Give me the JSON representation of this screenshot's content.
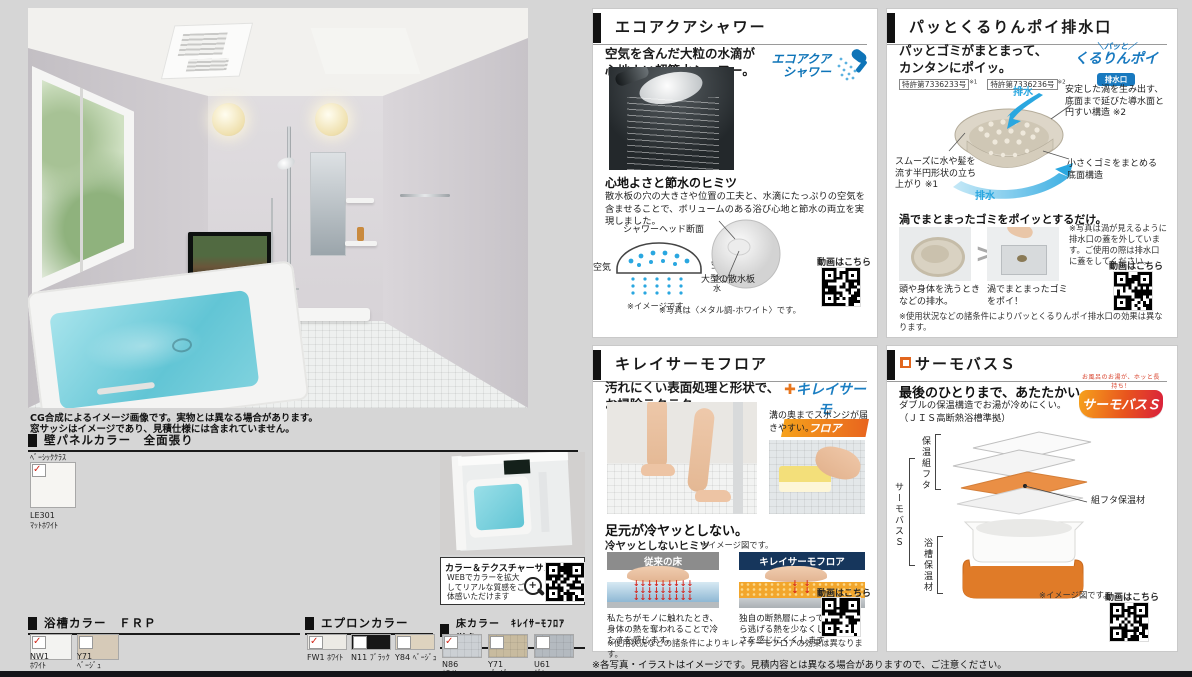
{
  "page": {
    "photo_notes": [
      "CG合成によるイメージ画像です。実物とは異なる場合があります。",
      "窓サッシはイメージであり、見積仕様には含まれていません。"
    ],
    "footer_note": "※各写真・イラストはイメージです。見積内容とは異なる場合がありますので、ご注意ください。",
    "video_label": "動画はこちら"
  },
  "colors": {
    "accent_blue": "#0e74b8",
    "swirl_blue": "#35a8dc",
    "navy": "#16365c",
    "orange": "#e8761e",
    "check_red": "#d2291c"
  },
  "wall_panel": {
    "title": "壁パネルカラー　全面張り",
    "grade": "ﾍﾞｰｼｯｸｸﾗｽ",
    "swatch": {
      "code": "LE301",
      "name": "ﾏｯﾄﾎﾜｲﾄ",
      "color": "#f6f5f2",
      "checked": true
    }
  },
  "texture_sample": {
    "title": "カラー＆テクスチャーサンプル",
    "body": "WEBでカラーを拡大してリアルな質感をご体感いただけます"
  },
  "tub_color": {
    "title": "浴槽カラー　ＦＲＰ",
    "swatches": [
      {
        "code": "NW1",
        "name": "ﾎﾜｲﾄ",
        "color": "#f3f3f1",
        "checked": true
      },
      {
        "code": "Y71",
        "name": "ﾍﾞｰｼﾞｭ",
        "color": "#d6cab8",
        "checked": false
      }
    ]
  },
  "apron_color": {
    "title": "エプロンカラー",
    "swatches": [
      {
        "code": "FW1",
        "name": "ﾎﾜｲﾄ",
        "color": "#eceae5",
        "checked": true
      },
      {
        "code": "N11",
        "name": "ﾌﾞﾗｯｸ",
        "color": "#161616",
        "checked": false
      },
      {
        "code": "Y84",
        "name": "ﾍﾞｰｼﾞｭ",
        "color": "#ded3bf",
        "checked": false
      }
    ]
  },
  "floor_color": {
    "title": "床カラー　ｷﾚｲｻｰﾓﾌﾛｱ　単色",
    "swatches": [
      {
        "code": "N86",
        "name": "ﾎﾜｲﾄ",
        "color": "#ccd0d4",
        "checked": true
      },
      {
        "code": "Y71",
        "name": "ﾍﾞｰｼﾞｭ",
        "color": "#c8bb9f",
        "checked": false
      },
      {
        "code": "U61",
        "name": "ｸﾞﾚｰ",
        "color": "#b4bac0",
        "checked": false
      }
    ]
  },
  "eco_shower": {
    "title": "エコアクアシャワー",
    "lead": [
      "空気を含んだ大粒の水滴が",
      "心地よい超節水シャワー。"
    ],
    "logo": [
      "エコアクア",
      "シャワー"
    ],
    "secret_title": "心地よさと節水のヒミツ",
    "secret_body": "散水板の穴の大きさや位置の工夫と、水滴にたっぷりの空気を含ませることで、ボリュームのある浴び心地と節水の両立を実現しました。",
    "diagram": {
      "head_section": "シャワーヘッド断面",
      "air_left": "空気",
      "air_right": "空気",
      "air_small": "空気",
      "water_small": "水",
      "image_note": "※イメージです。",
      "plate_label": "大型の散水板"
    },
    "photo_note": "※写真は〈メタル調-ホワイト〉です。"
  },
  "drain": {
    "title": "パッとくるりんポイ排水口",
    "lead": [
      "パッとゴミがまとまって、",
      "カンタンにポイッ。"
    ],
    "patents": [
      {
        "no": "特許第7336233号",
        "ref": "※1"
      },
      {
        "no": "特許第7336236号",
        "ref": "※2"
      }
    ],
    "logo": {
      "top": "＼パッと／",
      "main": "くるりんポイ",
      "badge": "排水口"
    },
    "labels": {
      "drain_top": "排水",
      "vortex": "安定した渦を生み出す、底面まで延びた導水面と円すい構造 ※2",
      "smooth": "スムーズに水や髪を流す半円形状の立ち上がり ※1",
      "bottom_structure": "小さくゴミをまとめる底面構造",
      "drain_bottom": "排水"
    },
    "point_line": "渦でまとまったゴミをポイッとするだけ。",
    "steps": [
      {
        "caption": "頭や身体を洗うときなどの排水。"
      },
      {
        "caption": "渦でまとまったゴミをポイ！"
      }
    ],
    "photo_note": "※写真は渦が見えるように排水口の蓋を外しています。ご使用の際は排水口に蓋をしてください。",
    "condition_note": "※使用状況などの諸条件によりパッとくるりんポイ排水口の効果は異なります。"
  },
  "kirei_floor": {
    "title": "キレイサーモフロア",
    "lead": [
      "汚れにくい表面処理と形状で、",
      "お掃除ラクラク。"
    ],
    "logo": {
      "main": "キレイサーモ",
      "sub": "フロア"
    },
    "sponge_note": "溝の奥までスポンジが届きやすい。",
    "warm_title": "足元が冷ヤッとしない。",
    "secret_label": "冷ヤッとしないヒミツ",
    "image_note": "※イメージ図です。",
    "compare": [
      {
        "header": "従来の床",
        "caption": "私たちがモノに触れたとき、身体の熱を奪われることで冷たさを感じます。"
      },
      {
        "header": "キレイサーモフロア",
        "caption": "独自の断熱層によって、足裏から逃げる熱を少なくして、冷たさを感じにくくします。"
      }
    ],
    "condition_note": "※使用状況などの諸条件によりキレイサーモフロアの効果は異なります。"
  },
  "thermo_bath": {
    "title": "サーモバスＳ",
    "lead": "最後のひとりまで、あたたかい。",
    "sub": "ダブルの保温構造でお湯が冷めにくい。",
    "jis": "（ＪＩＳ高断熱浴槽準拠）",
    "logo": {
      "arc": "お風呂のお湯が、ホッと長持ち！",
      "main": "サーモバスＳ"
    },
    "labels": {
      "lid": "保温組フタ",
      "lid_material": "組フタ保温材",
      "bath": "サーモバスＳ",
      "tub_material": "浴槽保温材"
    },
    "image_note": "※イメージ図です。"
  }
}
